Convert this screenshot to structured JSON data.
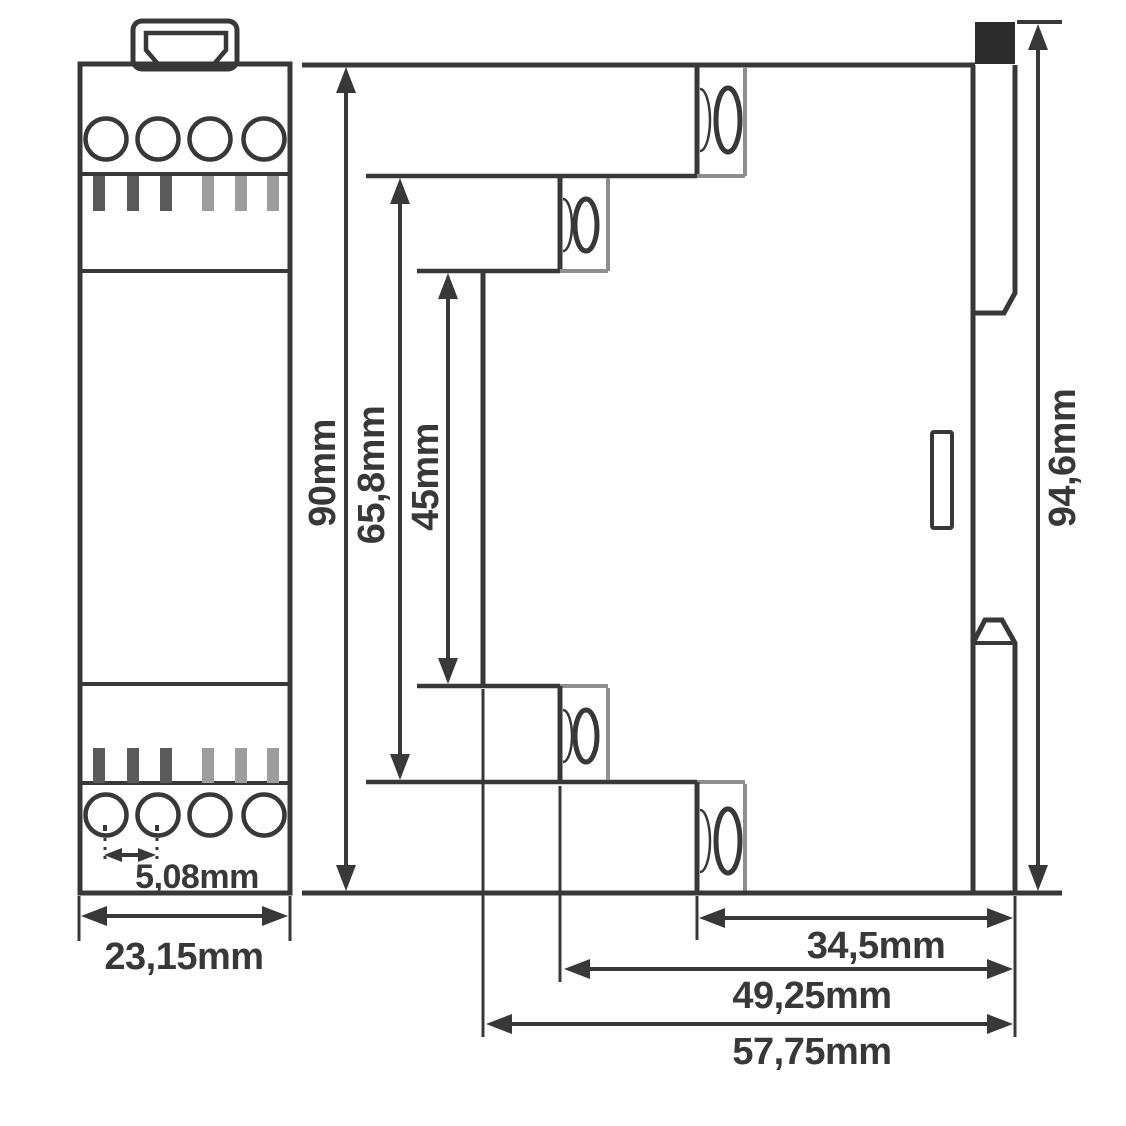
{
  "dimensions": {
    "pitch": "5,08mm",
    "module_width": "23,15mm",
    "module_height": "90mm",
    "upper_height": "65,8mm",
    "inner_height": "45mm",
    "total_height": "94,6mm",
    "depth_rail": "34,5mm",
    "depth_mid": "49,25mm",
    "depth_total": "57,75mm"
  },
  "colors": {
    "stroke": "#383838",
    "edge_gray": "#8e8e8e",
    "bar_dark": "#5a5a5a",
    "bar_light": "#9d9d9d",
    "clip_black": "#2b2b2b",
    "background": "#ffffff"
  }
}
